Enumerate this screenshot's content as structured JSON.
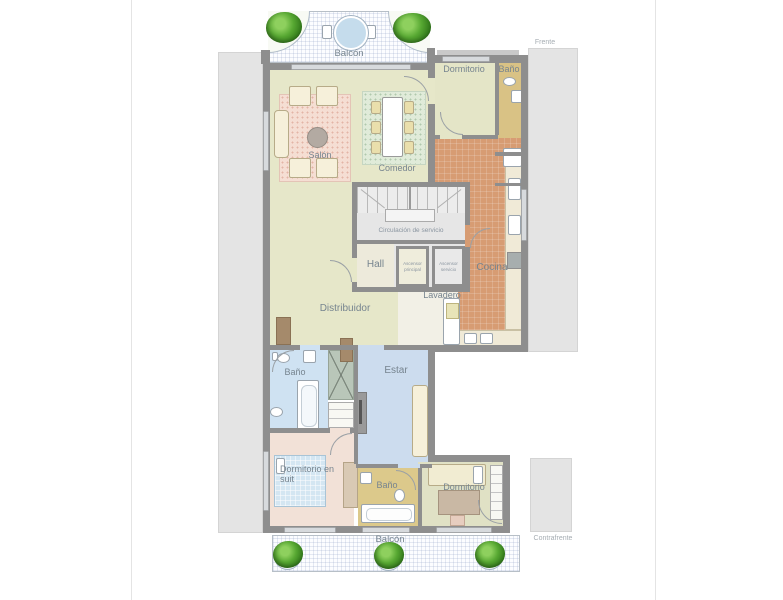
{
  "plan": {
    "orientation": {
      "front": "Frente",
      "back": "Contrafrente"
    },
    "rooms": {
      "balcony_front": "Balcón",
      "living": "Salón",
      "dining": "Comedor",
      "service_bedroom": "Dormitorio",
      "service_bathroom": "Baño",
      "service_circulation": "Circulación de servicio",
      "hall": "Hall",
      "main_elevator": "Ascensor principal",
      "service_elevator": "Ascensor servicio",
      "kitchen": "Cocina",
      "laundry": "Lavadero",
      "distributor": "Distribuidor",
      "bathroom_main": "Baño",
      "family_room": "Estar",
      "master_bedroom": "Dormitorio en suit",
      "bathroom_2": "Baño",
      "bedroom_2": "Dormitorio",
      "balcony_back": "Balcón"
    },
    "colors": {
      "wall": "#8e8e8e",
      "living_floor": "#e6e7c9",
      "kitchen_floor": "#d79c73",
      "main_bathroom_floor": "#cfe2f2",
      "family_room_floor": "#ccdcee",
      "master_bedroom_floor": "#f2e1d7",
      "bedroom2_floor": "#e0e1c5",
      "service_bathroom_floor": "#d9c285",
      "living_rug": "#f5ded3",
      "dining_rug": "#e0ebd9",
      "balcony_table": "#c5dcec",
      "plant_green": "#3f8a22",
      "label_text": "#76848f"
    }
  }
}
